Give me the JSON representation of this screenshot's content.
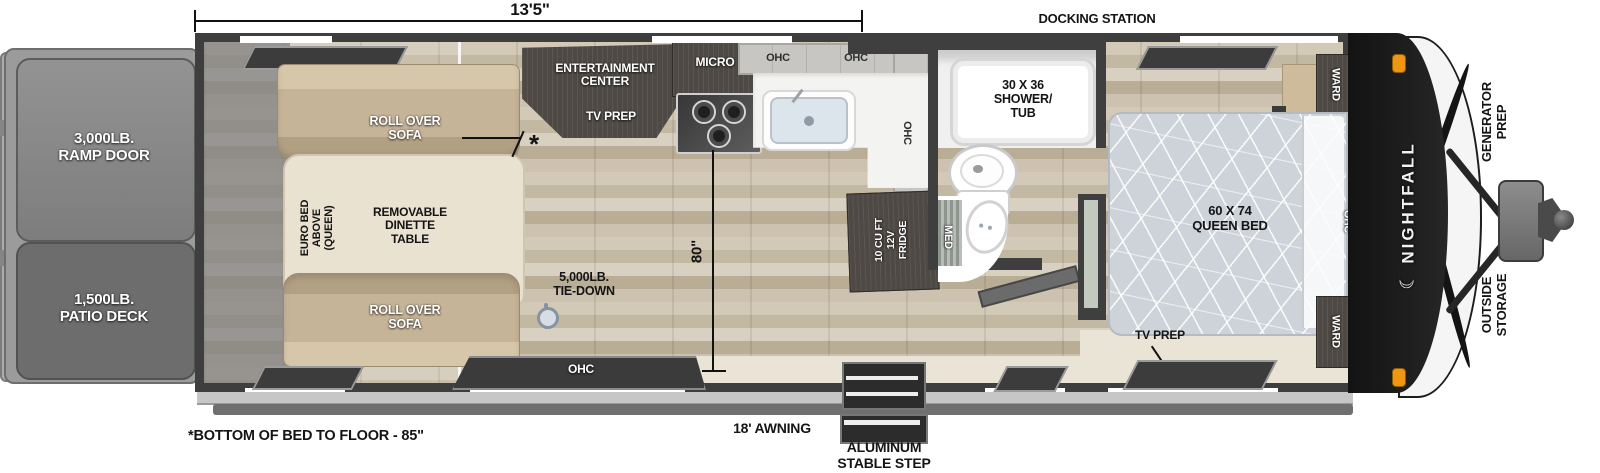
{
  "labels": {
    "garage_length": "13'5\"",
    "docking_station": "DOCKING STATION",
    "ramp_door": "3,000LB.\nRAMP DOOR",
    "patio_deck": "1,500LB.\nPATIO DECK",
    "sofa_top": "ROLL OVER\nSOFA",
    "sofa_bottom": "ROLL OVER\nSOFA",
    "euro_bed": "EURO BED\nABOVE\n(QUEEN)",
    "dinette": "REMOVABLE\nDINETTE\nTABLE",
    "asterisk": "*",
    "tie_down": "5,000LB.\nTIE-DOWN",
    "entertainment": "ENTERTAINMENT\nCENTER",
    "tv_prep_living": "TV PREP",
    "micro": "MICRO",
    "ohc_kitchen_1": "OHC",
    "ohc_kitchen_2": "OHC",
    "ohc_counter": "OHC",
    "ohc_galley": "OHC",
    "fridge": "10 CU FT\n12V\nFRIDGE",
    "shower": "30 X 36\nSHOWER/\nTUB",
    "med": "MED",
    "queen_bed": "60 X 74\nQUEEN BED",
    "ward_top": "WARD",
    "ward_bottom": "WARD",
    "ohc_bed": "OHC",
    "tv_prep_bedroom": "TV PREP",
    "width_dim": "80\"",
    "awning": "18' AWNING",
    "step": "ALUMINUM\nSTABLE STEP",
    "bed_floor_note": "*BOTTOM OF BED TO FLOOR - 85\"",
    "brand": "NIGHTFALL",
    "generator_prep": "GENERATOR\nPREP",
    "outside_storage": "OUTSIDE\nSTORAGE"
  },
  "icons": {
    "moon": "☾"
  },
  "colors": {
    "wall": "#3f3f3f",
    "wood_floor": "#cbc1ae",
    "sofa_tan": "#c6b498",
    "dinette_cream": "#eae2d0",
    "mattress": "#ced3d9",
    "cabinet_dark": "#4e4944",
    "cabinet_gray": "#c7c6c2",
    "front_cap": "#181818",
    "clearance_light": "#ef9613",
    "awning_gray": "#6f6f6f"
  }
}
